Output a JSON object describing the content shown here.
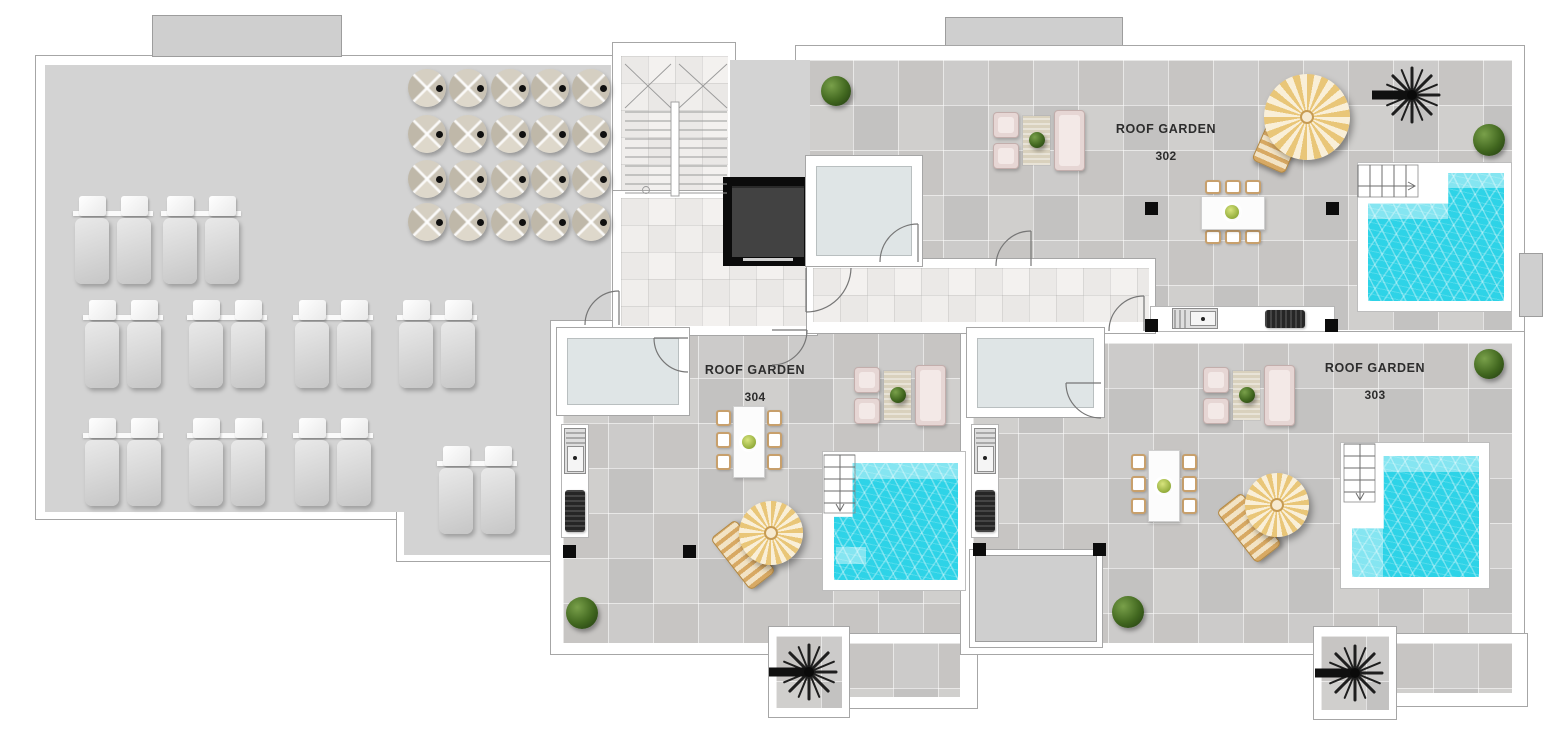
{
  "plan": {
    "type": "roof-floor-plan",
    "units": [
      {
        "label": "ROOF GARDEN",
        "number": "302"
      },
      {
        "label": "ROOF GARDEN",
        "number": "303"
      },
      {
        "label": "ROOF GARDEN",
        "number": "304"
      }
    ],
    "communal_terrace": {
      "sun_lounger_pairs": 10,
      "sun_loungers": 20,
      "closed_umbrella_tables": 20,
      "umbrella_grid": {
        "rows": 4,
        "cols": 5
      }
    },
    "shared_core": {
      "stairwell": 1,
      "elevator": 1,
      "roof_access_boxes": 3
    },
    "per_unit_features": {
      "pools": 3,
      "parasols": 3,
      "sun_beds": 3,
      "dining_sets": 3,
      "dining_chairs_per_set": 6,
      "lounge_sets": 3,
      "outdoor_kitchens": 3,
      "spiral_staircases": 3
    },
    "planting": {
      "bushes": 5,
      "potted_plants": 6
    },
    "colors": {
      "pool_water": "#2ed3e7",
      "pool_water_light": "#8ce7f0",
      "paving_tile": "#c8c7c6",
      "communal_surface": "#d3d3d3",
      "marble_core": "#efedec",
      "parasol_gold": "#e9c678",
      "parasol_cream": "#f9efd8",
      "elevator_black": "#0b0b0b",
      "skylight_glass": "#dfe5e6",
      "plant_green": "#41671f",
      "label_text": "#2d2d2d"
    }
  }
}
